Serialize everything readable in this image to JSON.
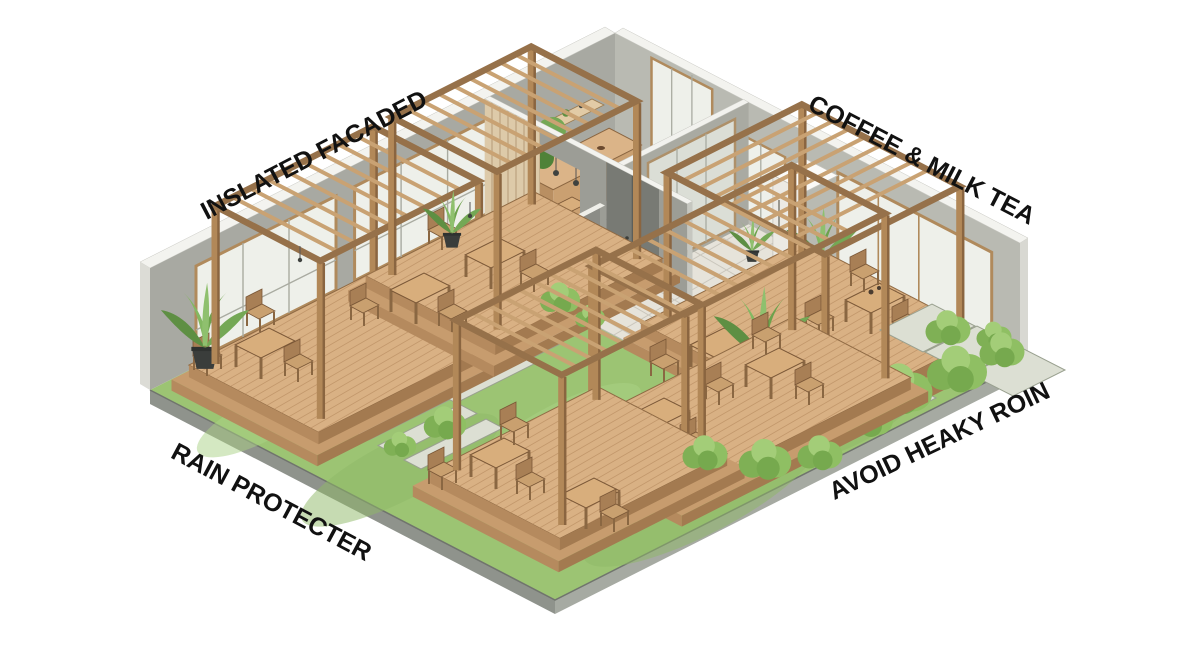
{
  "scene": {
    "type": "isometric architectural cutaway illustration",
    "subject": "Coffee and milk tea shop with garden pergola seating",
    "background": "#ffffff"
  },
  "labels": {
    "top_left": {
      "text": "INSLATED FACADED",
      "rotation_deg": -27.5
    },
    "top_right": {
      "text": "COFFEE & MILK TEA",
      "rotation_deg": 27.5
    },
    "bottom_left": {
      "text": "RAIN PROTECTER",
      "rotation_deg": 28
    },
    "bottom_right": {
      "text": "AVOID HEAKY ROIN",
      "rotation_deg": -25.5
    }
  },
  "palette": {
    "wall_grey": "#a8a9a2",
    "wall_cap_white": "#f3f3ef",
    "wood_frame": "#b28858",
    "deck_top": "#d9b184",
    "rafter": "#c9a273",
    "grass_green": "#9cc473",
    "paver_grey": "#dcdfd3",
    "tile_floor": "#e6e3da",
    "foliage_green": "#8fbf63",
    "slab_edge_grey": "#8f938c",
    "glass": "#eef0ea",
    "label_text": "#111111"
  }
}
